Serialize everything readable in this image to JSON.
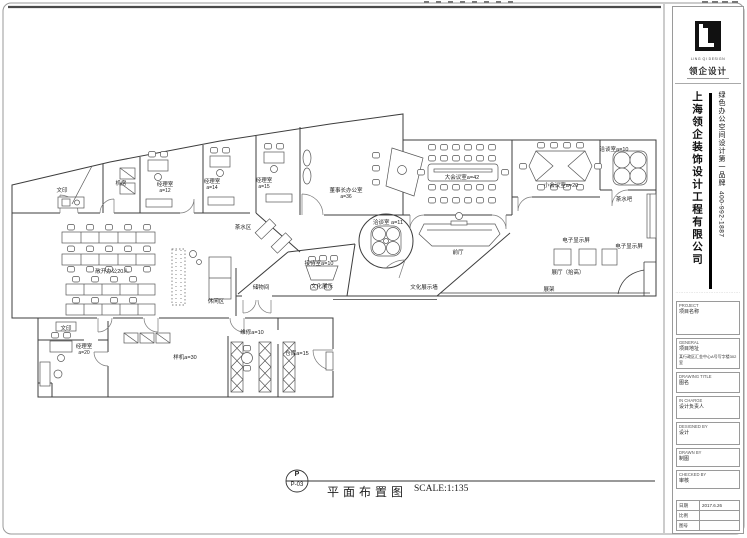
{
  "sheet": {
    "bubble_letter": "P",
    "drawing_number": "P-03",
    "title": "平面布置图",
    "scale": "SCALE:1:135"
  },
  "title_block": {
    "logo_name": "领企设计",
    "logo_caption": "LING QI DESIGN",
    "company_name": "上海领企装饰设计工程有限公司",
    "slogan": "绿色办公空间设计第一品牌",
    "phone": "400-992-1887",
    "fine_print": "·······································",
    "fields": [
      {
        "en": "PROJECT",
        "cn": "项目名称",
        "value": ""
      },
      {
        "en": "GENERAL",
        "cn": "项目地址",
        "value": "某行政区汇金中心A号写字楼302室"
      },
      {
        "en": "DRAWING TITLE",
        "cn": "图名",
        "value": ""
      },
      {
        "en": "IN CHARGE",
        "cn": "设计负责人",
        "value": ""
      },
      {
        "en": "DESIGNED BY",
        "cn": "设计",
        "value": ""
      },
      {
        "en": "DRAWN BY",
        "cn": "制图",
        "value": ""
      },
      {
        "en": "CHECKED BY",
        "cn": "审核",
        "value": ""
      }
    ],
    "meta_rows": [
      {
        "label": "日期",
        "value": "2017.6.26"
      },
      {
        "label": "比例",
        "value": ""
      },
      {
        "label": "图号",
        "value": ""
      }
    ]
  },
  "plan": {
    "rooms": [
      {
        "label": "文印",
        "x": 62,
        "y": 191
      },
      {
        "label": "机房",
        "x": 121,
        "y": 184
      },
      {
        "label": "经理室",
        "sub": "a=12",
        "x": 165,
        "y": 188
      },
      {
        "label": "经理室",
        "sub": "a=14",
        "x": 212,
        "y": 185
      },
      {
        "label": "经理室",
        "sub": "a=15",
        "x": 264,
        "y": 184
      },
      {
        "label": "茶水区",
        "x": 243,
        "y": 228
      },
      {
        "label": "敞开办公20人",
        "x": 112,
        "y": 272
      },
      {
        "label": "董事长办公室",
        "sub": "a=36",
        "x": 346,
        "y": 194
      },
      {
        "label": "洽谈室 a=11",
        "x": 388,
        "y": 223
      },
      {
        "label": "大会议室a=42",
        "x": 462,
        "y": 178
      },
      {
        "label": "小会议室a=20",
        "x": 561,
        "y": 186
      },
      {
        "label": "洽谈室a=10",
        "x": 614,
        "y": 150
      },
      {
        "label": "茶水吧",
        "x": 624,
        "y": 200
      },
      {
        "label": "前厅",
        "x": 458,
        "y": 253
      },
      {
        "label": "电子显示屏",
        "x": 576,
        "y": 241
      },
      {
        "label": "电子显示屏",
        "x": 629,
        "y": 247
      },
      {
        "label": "展厅（抬高）",
        "x": 568,
        "y": 273
      },
      {
        "label": "展架",
        "x": 549,
        "y": 290
      },
      {
        "label": "文化展示墙",
        "x": 424,
        "y": 288
      },
      {
        "label": "接待室a=10",
        "x": 319,
        "y": 264
      },
      {
        "label": "文化展示",
        "x": 322,
        "y": 287
      },
      {
        "label": "储物间",
        "x": 261,
        "y": 288
      },
      {
        "label": "休闲区",
        "x": 216,
        "y": 302
      },
      {
        "label": "维修a=10",
        "x": 252,
        "y": 333
      },
      {
        "label": "仓库a=15",
        "x": 297,
        "y": 354
      },
      {
        "label": "样机a=30",
        "x": 185,
        "y": 358
      },
      {
        "label": "经理室",
        "sub": "a=20",
        "x": 84,
        "y": 350
      },
      {
        "label": "文印",
        "x": 66,
        "y": 329
      }
    ]
  }
}
